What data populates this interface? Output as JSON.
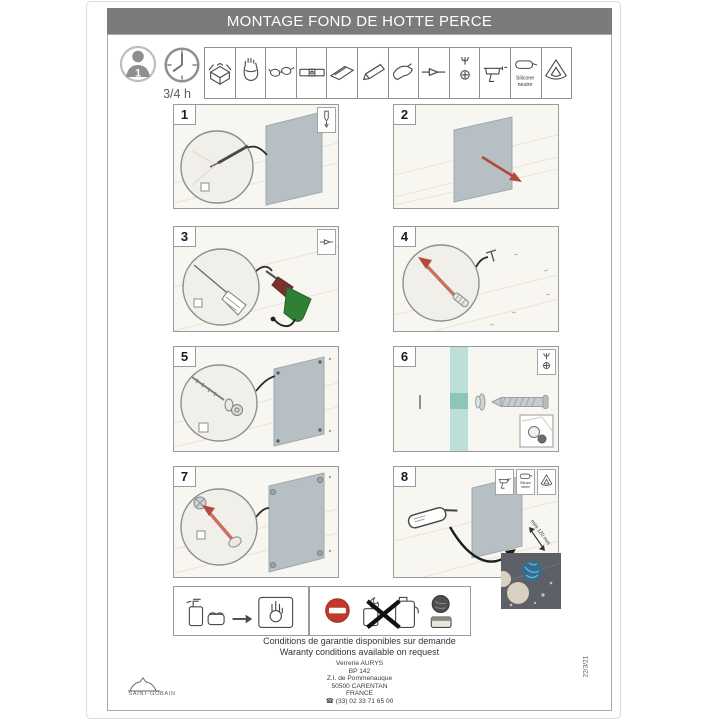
{
  "title": "MONTAGE FOND DE HOTTE PERCE",
  "meta": {
    "people_count": "1",
    "duration": "3/4 h"
  },
  "tools": [
    {
      "name": "toolbox"
    },
    {
      "name": "work-gloves"
    },
    {
      "name": "safety-glasses"
    },
    {
      "name": "spirit-level"
    },
    {
      "name": "try-square"
    },
    {
      "name": "pencil"
    },
    {
      "name": "power-drill"
    },
    {
      "name": "drill-bit"
    },
    {
      "name": "screw-and-bit"
    },
    {
      "name": "caulking-gun"
    },
    {
      "name": "silicone-tube",
      "label_line1": "Silicone",
      "label_line2": "neutre"
    },
    {
      "name": "smoothing-triangle"
    }
  ],
  "steps": [
    {
      "number": "1",
      "corner_icons": [
        "pencil-mark"
      ]
    },
    {
      "number": "2",
      "corner_icons": []
    },
    {
      "number": "3",
      "corner_icons": [
        "drill-bit"
      ]
    },
    {
      "number": "4",
      "corner_icons": []
    },
    {
      "number": "5",
      "corner_icons": []
    },
    {
      "number": "6",
      "corner_icons": [
        "screwdriver-bit"
      ]
    },
    {
      "number": "7",
      "corner_icons": []
    },
    {
      "number": "8",
      "corner_icons": [
        "caulking-gun",
        "silicone-tube",
        "smoothing-triangle"
      ],
      "silicone_icon_line1": "Silicone",
      "silicone_icon_line2": "neutre",
      "annotation": "mini 120 mm"
    }
  ],
  "care": {
    "cleaning_icons": [
      "spray-bottle",
      "sponge",
      "arrow-right",
      "wipe-hand-cloth"
    ],
    "forbidden_icons": [
      "no-entry-sign",
      "flammable-solvent-products-crossed",
      "scouring-pad",
      "abrasive-sponge"
    ]
  },
  "footer": {
    "warranty_fr": "Conditions de garantie disponibles sur demande",
    "warranty_en": "Waranty conditions available on request",
    "address": [
      "Verrerie AURYS",
      "BP 142",
      "Z.I. de Pommenauque",
      "50500 CARENTAN",
      "FRANCE"
    ],
    "phone_icon": "☎",
    "phone": "(33) 02 33 71 65 00",
    "brand": "SAINT-GOBAIN",
    "doc_ref": "22/3/21"
  },
  "colors": {
    "titlebar_gray": "#7b7b7b",
    "glass_pane": "#b6bfc3",
    "glass_teal": "#bcdfd8",
    "accent_red": "#b5493c",
    "drill_green": "#2f8035",
    "prohibition_red": "#c0392b",
    "photo_inset_gray": "#5d6067"
  }
}
